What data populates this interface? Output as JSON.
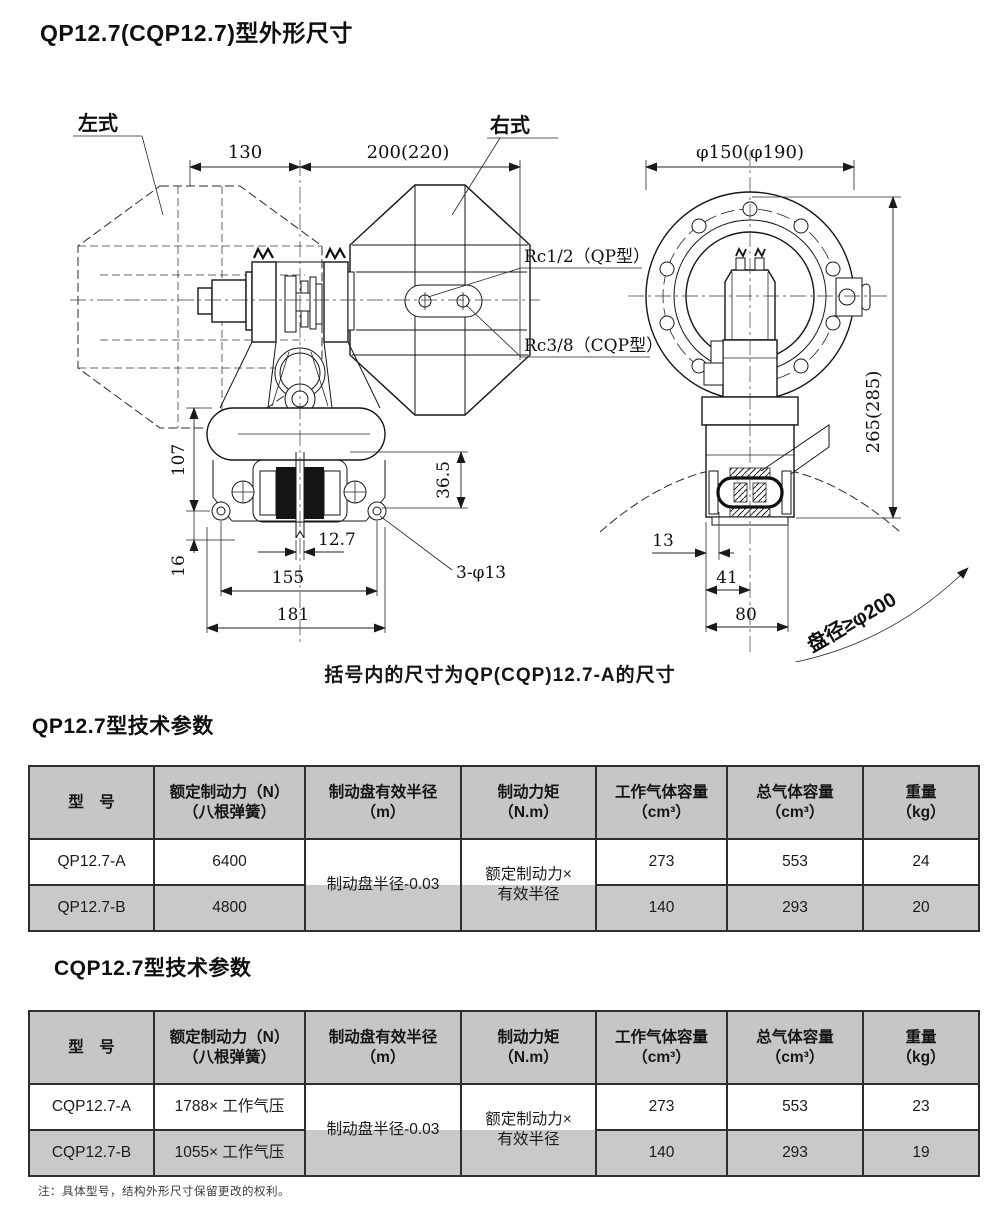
{
  "titles": {
    "main": "QP12.7(CQP12.7)型外形尺寸",
    "caption": "括号内的尺寸为QP(CQP)12.7-A的尺寸",
    "table1": "QP12.7型技术参数",
    "table2": "CQP12.7型技术参数",
    "footnote": "注：具体型号，结构外形尺寸保留更改的权利。"
  },
  "drawing": {
    "side": {
      "label_left": "左式",
      "label_right": "右式",
      "dim130": "130",
      "dim200": "200(220)",
      "dim107": "107",
      "dim16": "16",
      "dim365": "36.5",
      "dim127": "12.7",
      "dim155": "155",
      "dim181": "181",
      "holes": "3-φ13",
      "port_qp": "Rc1/2（QP型）",
      "port_cqp": "Rc3/8（CQP型）"
    },
    "front": {
      "dia": "φ150(φ190)",
      "height": "265(285)",
      "d13": "13",
      "d41": "41",
      "d80": "80",
      "disc": "盘径≥φ200"
    }
  },
  "colors": {
    "header_bg": "#c6c6c6",
    "row_alt_bg": "#c9c9c9",
    "paper": "#ffffff",
    "ink": "#1b1b1b"
  },
  "tables": [
    {
      "headers": [
        [
          "型　号",
          ""
        ],
        [
          "额定制动力（N）",
          "（八根弹簧）"
        ],
        [
          "制动盘有效半径",
          "（m）"
        ],
        [
          "制动力矩",
          "（N.m）"
        ],
        [
          "工作气体容量",
          "（cm³）"
        ],
        [
          "总气体容量",
          "（cm³）"
        ],
        [
          "重量",
          "（kg）"
        ]
      ],
      "merged": {
        "radius": "制动盘半径-0.03",
        "torque1": "额定制动力×",
        "torque2": "有效半径"
      },
      "rows": [
        {
          "model": "QP12.7-A",
          "force": "6400",
          "work": "273",
          "total": "553",
          "weight": "24"
        },
        {
          "model": "QP12.7-B",
          "force": "4800",
          "work": "140",
          "total": "293",
          "weight": "20"
        }
      ]
    },
    {
      "headers": [
        [
          "型　号",
          ""
        ],
        [
          "额定制动力（N）",
          "（八根弹簧）"
        ],
        [
          "制动盘有效半径",
          "（m）"
        ],
        [
          "制动力矩",
          "（N.m）"
        ],
        [
          "工作气体容量",
          "（cm³）"
        ],
        [
          "总气体容量",
          "（cm³）"
        ],
        [
          "重量",
          "（kg）"
        ]
      ],
      "merged": {
        "radius": "制动盘半径-0.03",
        "torque1": "额定制动力×",
        "torque2": "有效半径"
      },
      "rows": [
        {
          "model": "CQP12.7-A",
          "force": "1788× 工作气压",
          "work": "273",
          "total": "553",
          "weight": "23"
        },
        {
          "model": "CQP12.7-B",
          "force": "1055× 工作气压",
          "work": "140",
          "total": "293",
          "weight": "19"
        }
      ]
    }
  ]
}
